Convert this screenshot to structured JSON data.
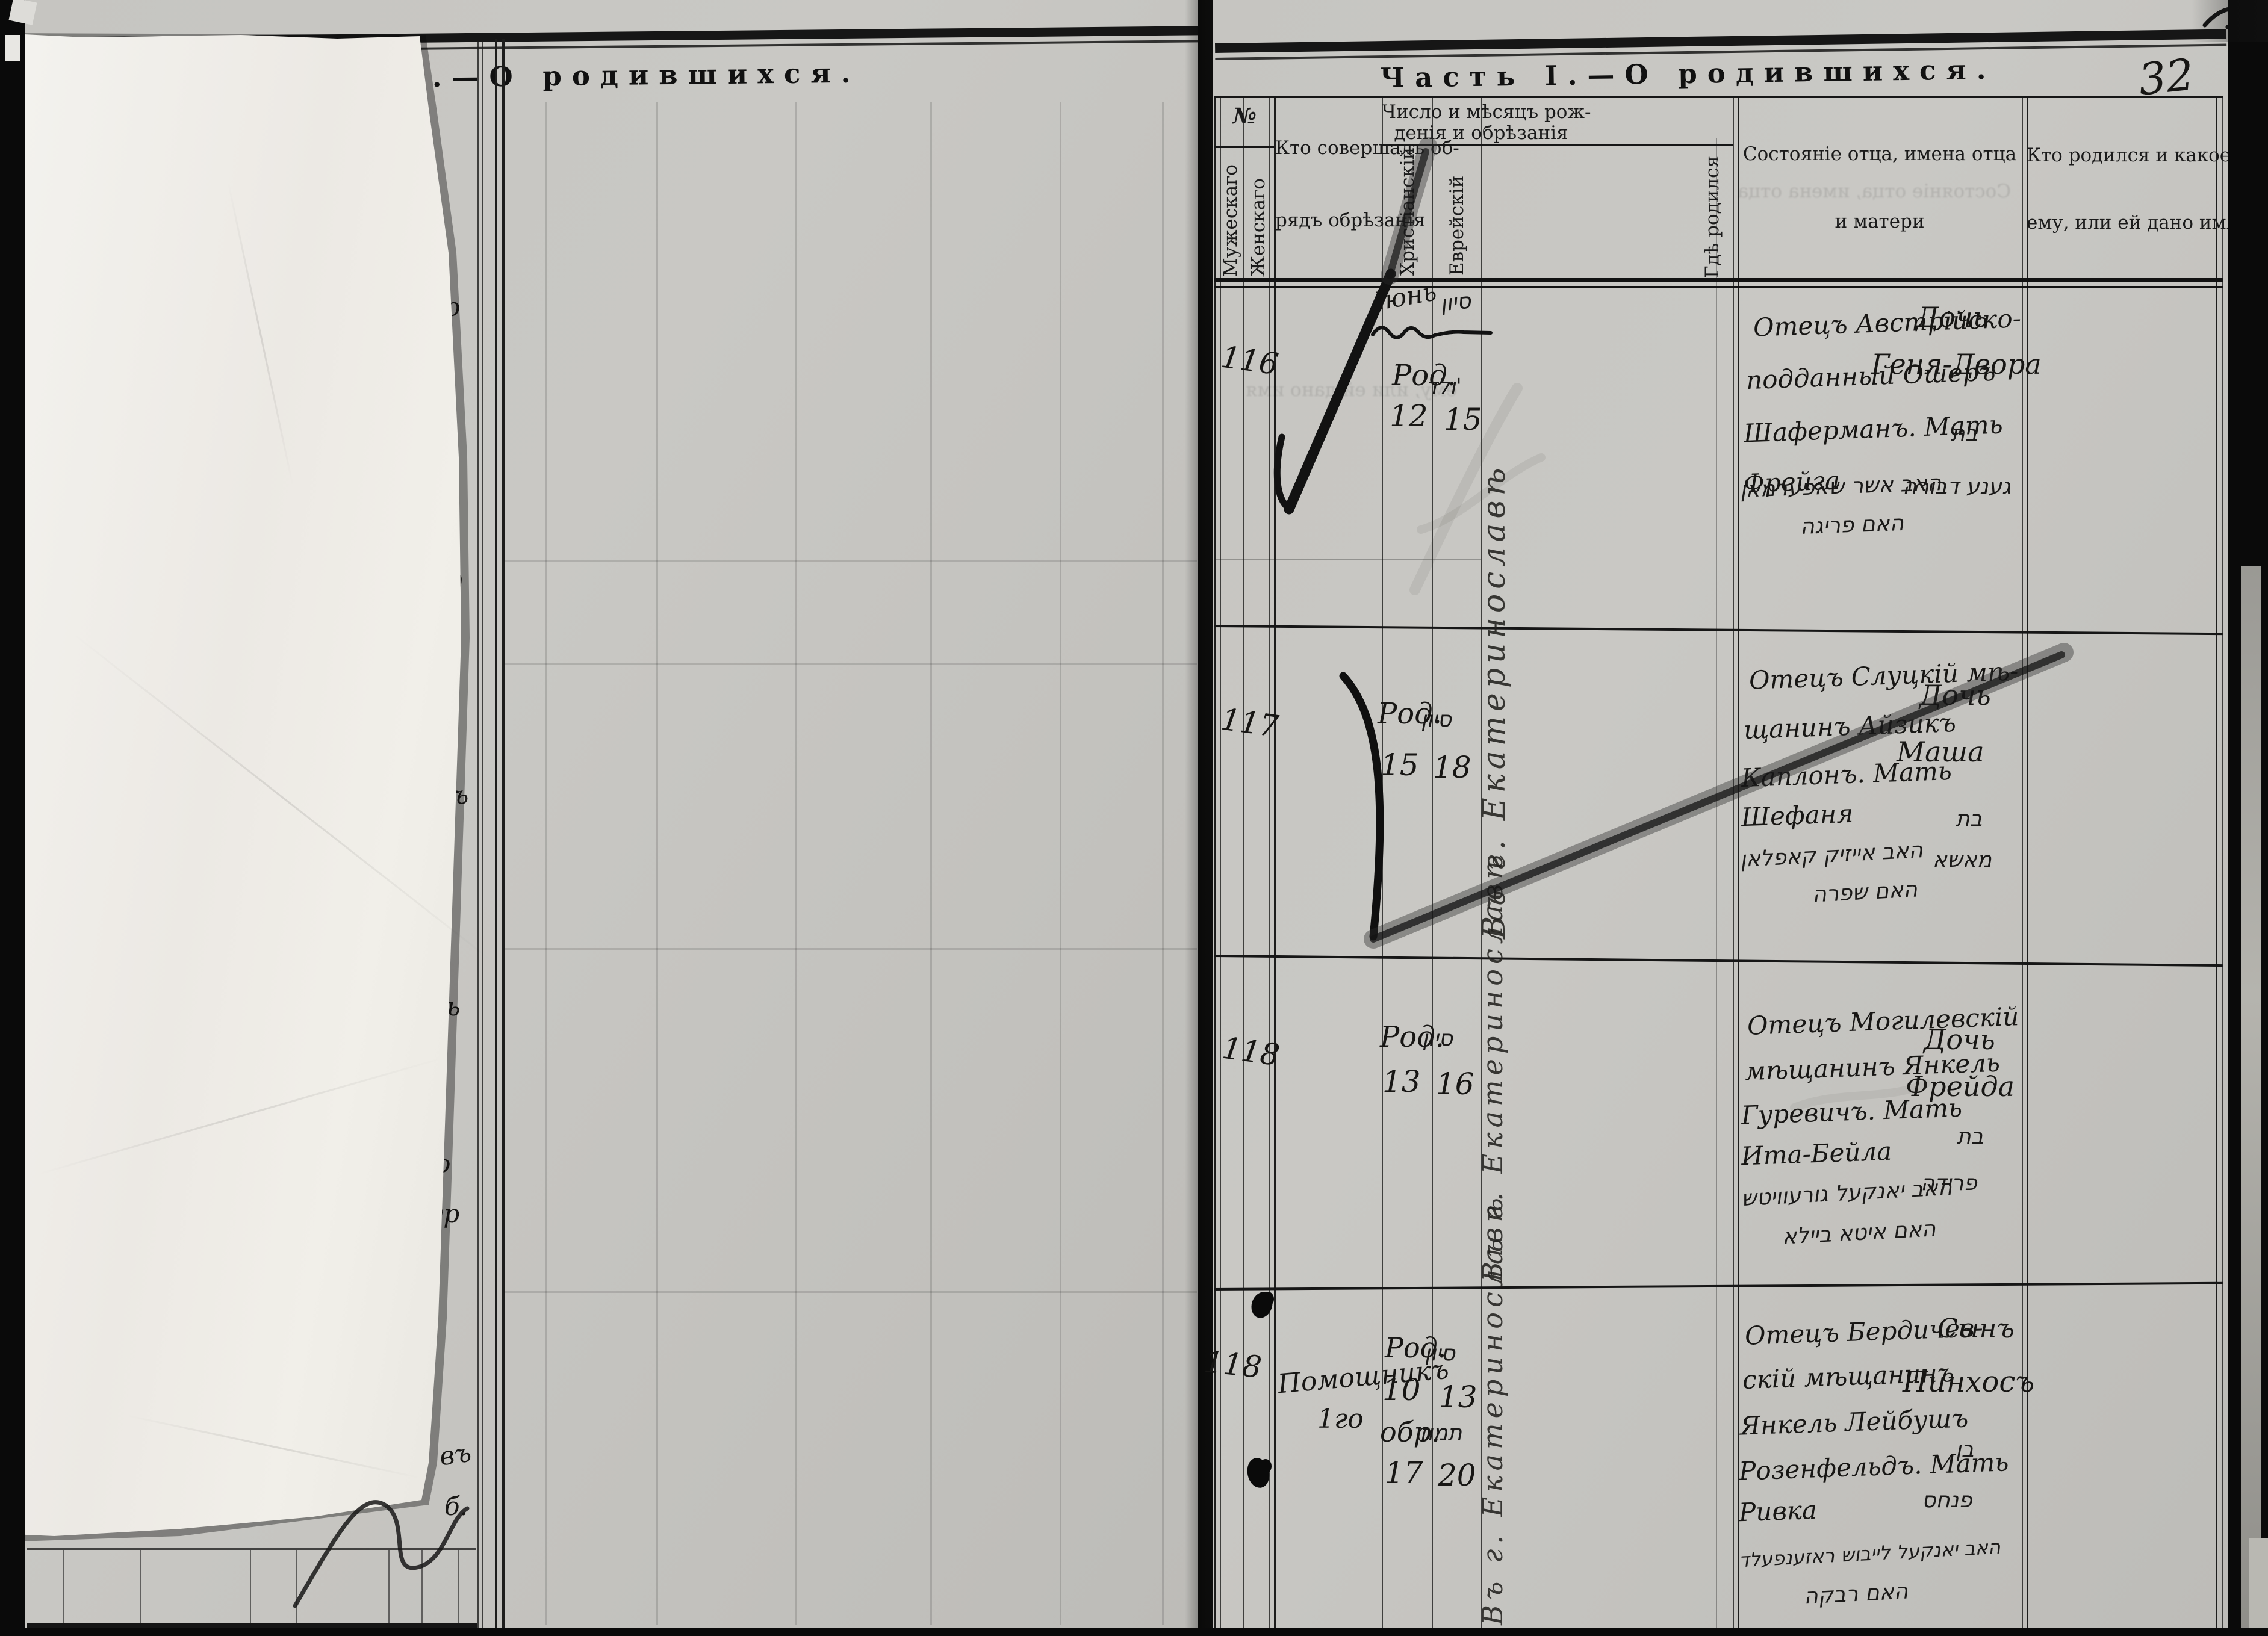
{
  "page": {
    "left_title": "Часть I.—О родившихся.",
    "right_title": "Часть I.—О родившихся.",
    "page_number": "32"
  },
  "table": {
    "headers": {
      "no": "№",
      "male": "Мужескаго",
      "female": "Женскаго",
      "mohel_line1": "Кто совершалъ об-",
      "mohel_line2": "рядъ обрѣзанія",
      "date_line1": "Число и мѣсяцъ рож-",
      "date_line2": "денія и обрѣзанія",
      "christian": "Христіанскій",
      "jewish": "Еврейскій",
      "birthplace": "Гдѣ родился",
      "parents_line1": "Состояніе отца, имена отца",
      "parents_line2": "и матери",
      "child_line1": "Кто родился и какое",
      "child_line2": "ему, или ей дано имя"
    },
    "entries": [
      {
        "no": "116",
        "month_ru": "Іюнь",
        "month_he": "סיון",
        "born_label": "Род.",
        "word_he": "ולד'",
        "day_ru": "12",
        "day_he": "15",
        "birthplace_vertical": "Въ г. Екатеринославѣ",
        "parents": [
          "Отецъ Австрійско-",
          "подданный Ошеръ",
          "Шаферманъ. Мать",
          "Фрейга"
        ],
        "parents_he": [
          "האב אשר שאפערמאן",
          "האם פריגה"
        ],
        "child": [
          "Дочь",
          "Геня-Двора"
        ],
        "child_he": [
          "בת",
          "גענע דבורה"
        ]
      },
      {
        "no": "117",
        "born_label": "Род.",
        "word_he": "סיון",
        "day_ru": "15",
        "day_he": "18",
        "birthplace_vertical": "Въ г. Екатеринославѣ",
        "parents": [
          "Отецъ Слуцкій мѣ-",
          "щанинъ Айзикъ",
          "Каплонъ. Мать",
          "Шефаня"
        ],
        "parents_he": [
          "האב אייזיק קאפלאן",
          "האם שפרה"
        ],
        "child": [
          "Дочь",
          "Маша"
        ],
        "child_he": [
          "בת",
          "מאשא"
        ]
      },
      {
        "no": "118",
        "born_label": "Род.",
        "word_he": "סיון",
        "day_ru": "13",
        "day_he": "16",
        "birthplace_vertical": "Въ г. Екатеринославѣ",
        "parents": [
          "Отецъ Могилевскій",
          "мѣщанинъ Янкель",
          "Гуревичъ. Мать",
          "Ита-Бейла"
        ],
        "parents_he": [
          "האב יאנקעל גורעוויטש",
          "האם איטא ביילא"
        ],
        "child": [
          "Дочь",
          "Фрейда"
        ],
        "child_he": [
          "בת",
          "פרידה"
        ]
      },
      {
        "no": "118",
        "mohel": [
          "Помощникъ",
          "1го"
        ],
        "chr": [
          "Род.",
          "10",
          "обр.",
          "17"
        ],
        "heb": [
          "סיון",
          "13",
          "תמוז",
          "20"
        ],
        "birthplace_vertical": "Въ г. Екатеринославѣ",
        "parents": [
          "Отецъ Бердичев-",
          "скій мѣщанинъ",
          "Янкель Лейбушъ",
          "Розенфельдъ. Мать",
          "Ривка"
        ],
        "parents_he": [
          "האב יאנקעל לייבוש ראזענפעלד",
          "האם רבקה"
        ],
        "child": [
          "Сынъ",
          "Пинхосъ"
        ],
        "child_he": [
          "בן",
          "פנחס"
        ]
      }
    ]
  },
  "left_page": {
    "fragments": [
      "схо",
      "д",
      "изъ",
      "ль",
      "го",
      "ур",
      "въ",
      "б."
    ]
  }
}
